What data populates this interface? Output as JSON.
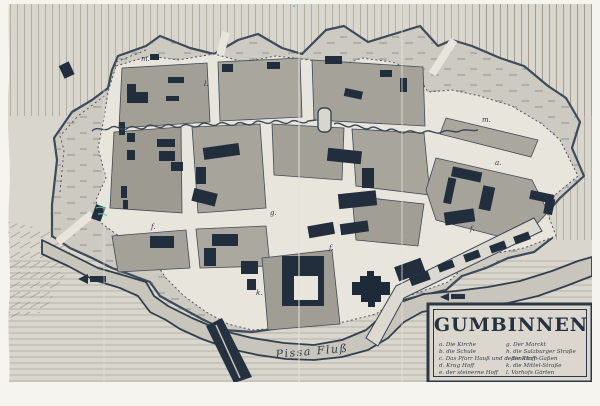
{
  "photo": {
    "description": "black-and-white photograph of a hand-drawn 18th-century town plan",
    "town": "Gumbinnen"
  },
  "cartouche": {
    "title": "GUMBINNEN",
    "legend_left": [
      "a. Die Kirche",
      "b. die Schule",
      "c. Das Pfarr Hauß und deßen Hoff",
      "d. Krug Hoff",
      "e. der steinerne Hoff"
    ],
    "legend_right": [
      "g. Der Marckt",
      "h. die Salzburger Straße",
      "i. die Kirch-Gaßen",
      "k. die Mittel-Straße",
      "l. Vorhofs Gärten"
    ]
  },
  "map_labels": {
    "river": "Pissa Fluß",
    "markers": [
      "m.",
      "l.",
      "m.",
      "a.",
      "f.",
      "g.",
      "f.",
      "f.",
      "k."
    ]
  },
  "colors": {
    "ink": "#26313f",
    "paper_margin": "#f6f4ee",
    "photo_base": "#d9d6ce",
    "street": "#e8e5dd",
    "block": "#a7a49b",
    "glacis": "#cdcac1",
    "river": "#c8c5bc",
    "crayon_mark": "#5fc8ba"
  }
}
